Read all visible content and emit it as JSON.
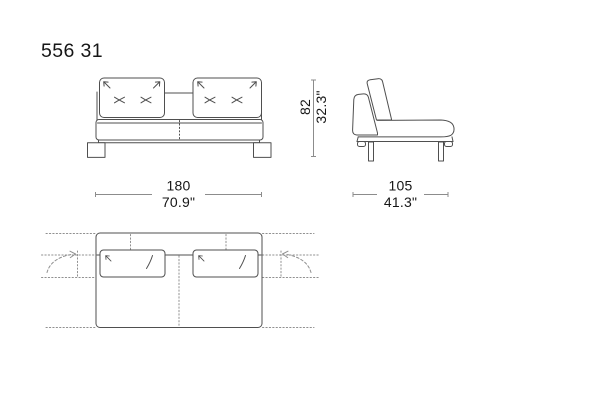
{
  "product": {
    "code": "556 31"
  },
  "dimensions": {
    "width": {
      "cm": "180",
      "inches": "70.9\""
    },
    "depth": {
      "cm": "105",
      "inches": "41.3\""
    },
    "height": {
      "cm": "82",
      "inches": "32.3\""
    }
  },
  "colors": {
    "background": "#ffffff",
    "artwork_line": "#4f4f4f",
    "dimension_line": "#8c8c8c",
    "guide_dotted": "#909090",
    "text": "#161616"
  }
}
